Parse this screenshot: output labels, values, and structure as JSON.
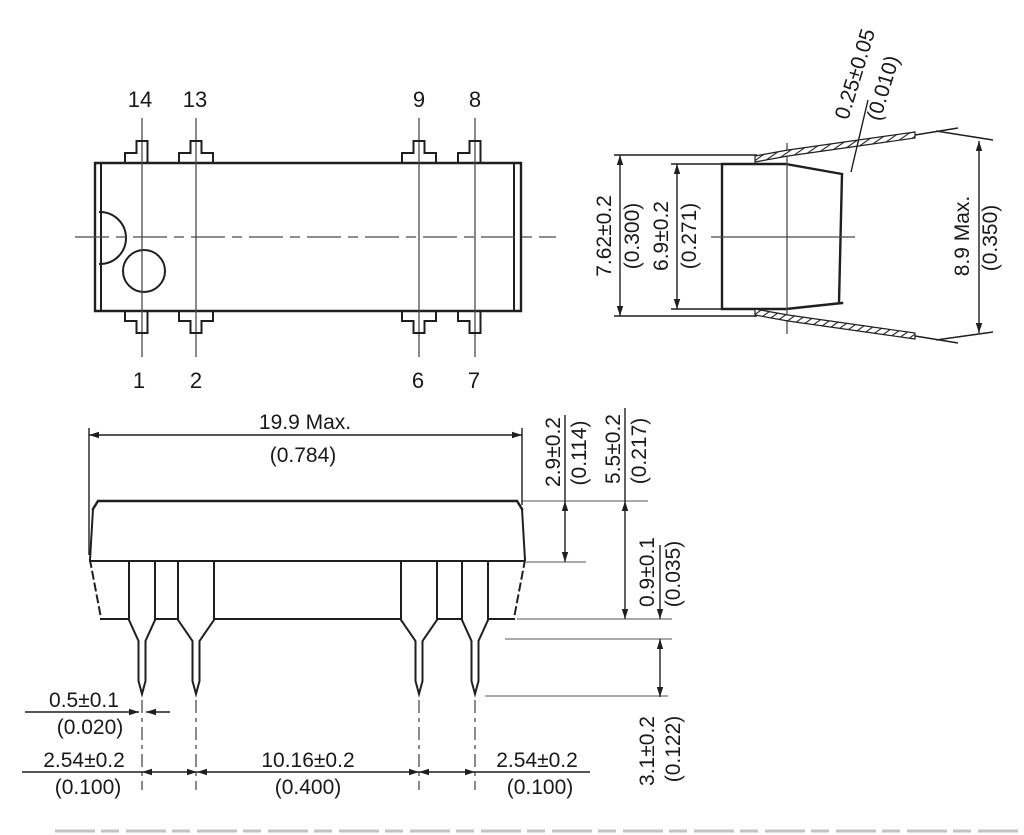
{
  "top_view": {
    "pins_top": [
      "14",
      "13",
      "9",
      "8"
    ],
    "pins_bottom": [
      "1",
      "2",
      "6",
      "7"
    ]
  },
  "side_view": {
    "pin_thickness": {
      "mm": "0.25±0.05",
      "inch": "(0.010)"
    },
    "row_spacing": {
      "mm": "7.62±0.2",
      "inch": "(0.300)"
    },
    "body_width": {
      "mm": "6.9±0.2",
      "inch": "(0.271)"
    },
    "overall_width": {
      "mm": "8.9 Max.",
      "inch": "(0.350)"
    }
  },
  "front_view": {
    "body_length": {
      "mm": "19.9 Max.",
      "inch": "(0.784)"
    },
    "upper_body_height": {
      "mm": "2.9±0.2",
      "inch": "(0.114)"
    },
    "body_height": {
      "mm": "5.5±0.2",
      "inch": "(0.217)"
    },
    "standoff_height": {
      "mm": "0.9±0.1",
      "inch": "(0.035)"
    },
    "pin_tip_length": {
      "mm": "3.1±0.2",
      "inch": "(0.122)"
    },
    "pin_width": {
      "mm": "0.5±0.1",
      "inch": "(0.020)"
    },
    "pitch_left": {
      "mm": "2.54±0.2",
      "inch": "(0.100)"
    },
    "center_span": {
      "mm": "10.16±0.2",
      "inch": "(0.400)"
    },
    "pitch_right": {
      "mm": "2.54±0.2",
      "inch": "(0.100)"
    }
  },
  "colors": {
    "line": "#1f1f1f",
    "aux": "#8d8d8d",
    "background": "#ffffff"
  }
}
